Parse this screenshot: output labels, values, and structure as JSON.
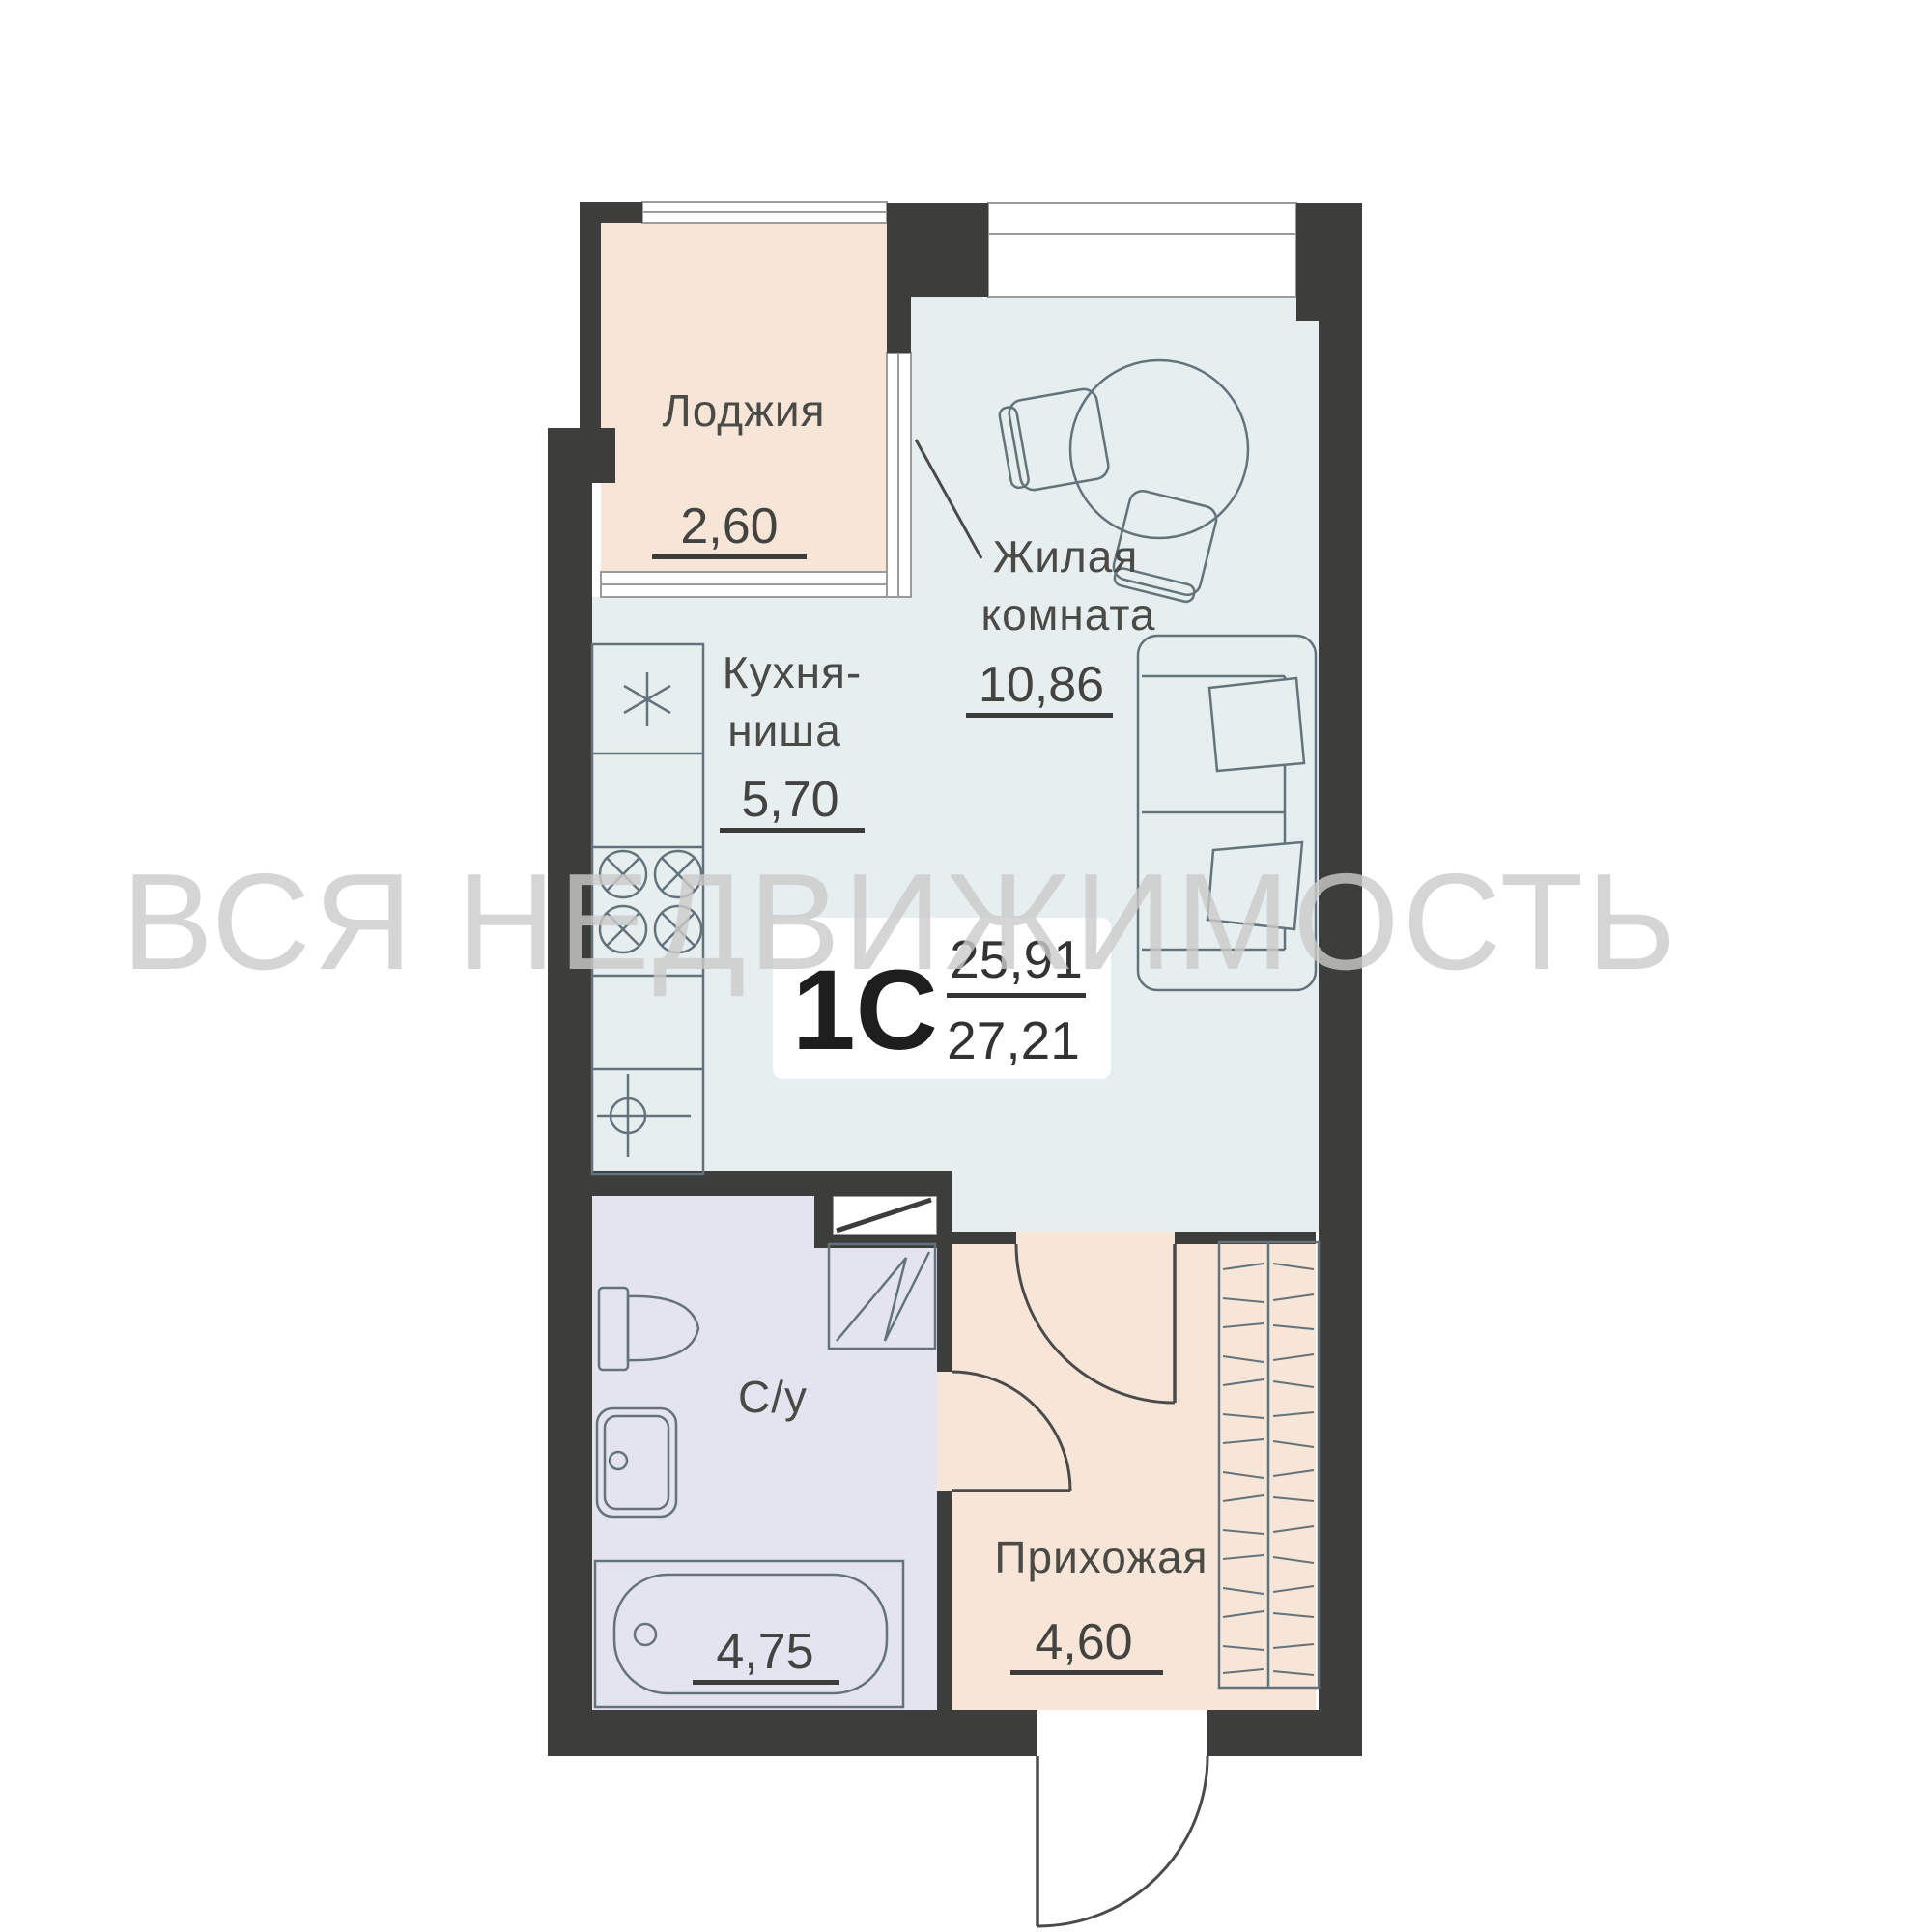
{
  "watermark_text": "ВСЯ НЕДВИЖИМОСТЬ",
  "badge": {
    "type": "1С",
    "area_living": "25,91",
    "area_total": "27,21"
  },
  "rooms": {
    "loggia": {
      "label": "Лоджия",
      "area": "2,60"
    },
    "kitchen": {
      "label_line1": "Кухня-",
      "label_line2": "ниша",
      "area": "5,70"
    },
    "living": {
      "label_line1": "Жилая",
      "label_line2": "комната",
      "area": "10,86"
    },
    "bathroom": {
      "label": "С/у",
      "area": "4,75"
    },
    "hallway": {
      "label": "Прихожая",
      "area": "4,60"
    }
  },
  "colors": {
    "wall": "#3d3d3b",
    "loggia_fill": "#f7e6d7",
    "hallway_fill": "#f7e6d7",
    "living_fill": "#e6eef0",
    "bathroom_fill": "#e4e4f1",
    "window_fill": "#ffffff",
    "furniture_stroke": "#64737b",
    "label_text": "#4a4a47",
    "watermark": "#cacaca"
  }
}
